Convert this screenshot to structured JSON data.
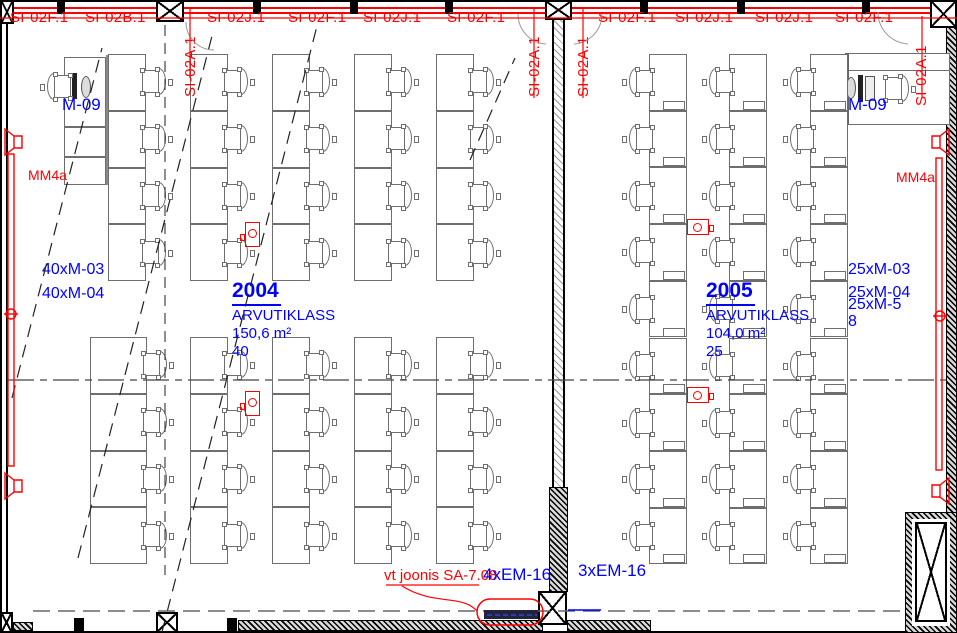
{
  "meta": {
    "drawing_type": "architectural floor plan",
    "rooms_shown": [
      "2004",
      "2005"
    ]
  },
  "colors": {
    "annotation_red": "#ff0000",
    "annotation_blue": "#0000ff",
    "furniture_line": "#6e6e6e",
    "wall": "#000000"
  },
  "top_wall_labels": [
    {
      "text": "SI-02F.1",
      "x": 10,
      "vertical": false
    },
    {
      "text": "SI-02B.1",
      "x": 85,
      "vertical": false
    },
    {
      "text": "SI-02A.1",
      "x": 182,
      "vertical": true
    },
    {
      "text": "SI-02J.1",
      "x": 207,
      "vertical": false
    },
    {
      "text": "SI-02F.1",
      "x": 288,
      "vertical": false
    },
    {
      "text": "SI-02J.1",
      "x": 363,
      "vertical": false
    },
    {
      "text": "SI-02F.1",
      "x": 447,
      "vertical": false
    },
    {
      "text": "SI-02A.1",
      "x": 526,
      "vertical": true
    },
    {
      "text": "SI-02A.1",
      "x": 575,
      "vertical": true
    },
    {
      "text": "SI-02F.1",
      "x": 598,
      "vertical": false
    },
    {
      "text": "SI-02J.1",
      "x": 675,
      "vertical": false
    },
    {
      "text": "SI-02J.1",
      "x": 755,
      "vertical": false
    },
    {
      "text": "SI-02F.1",
      "x": 835,
      "vertical": false
    },
    {
      "text": "SI-02A.1",
      "x": 913,
      "vertical": true
    }
  ],
  "rooms": [
    {
      "number": "2004",
      "name": "ARVUTIKLASS",
      "area": "150,6 m²",
      "seat_count": "40",
      "label_pos": {
        "x": 232,
        "y": 279
      },
      "equipment_labels": [
        {
          "text": "40xM-03",
          "x": 42,
          "y": 261
        },
        {
          "text": "40xM-04",
          "x": 42,
          "y": 285
        }
      ],
      "teacher_desk_label": {
        "text": "M-09"
      },
      "grid": {
        "desk_w": 38,
        "cell_h": 56.8,
        "chair_side": "right",
        "pc_notch": false,
        "groups": [
          {
            "y": 54,
            "rows": 4,
            "cols": [
              108,
              190,
              272,
              354,
              436
            ],
            "col_w": [
              38,
              38,
              38,
              38,
              38
            ]
          },
          {
            "y": 337,
            "rows": 4,
            "cols": [
              90,
              190,
              272,
              354,
              436
            ],
            "col_w": [
              57,
              38,
              38,
              38,
              38
            ]
          }
        ]
      }
    },
    {
      "number": "2005",
      "name": "ARVUTIKLASS",
      "area": "104,0 m²",
      "seat_count": "25",
      "label_pos": {
        "x": 706,
        "y": 279
      },
      "equipment_labels": [
        {
          "text": "25xM-03",
          "x": 848,
          "y": 261
        },
        {
          "text": "25xM-04",
          "x": 848,
          "y": 284
        },
        {
          "text": "25xM-5",
          "x": 848,
          "y": 296
        },
        {
          "text": "8",
          "x": 848,
          "y": 313
        }
      ],
      "teacher_desk_label": {
        "text": "M-09"
      },
      "grid": {
        "desk_w": 38,
        "cell_h": 56.7,
        "chair_side": "left",
        "pc_notch": true,
        "groups": [
          {
            "y": 54,
            "rows": 9,
            "cols": [
              649,
              729,
              810
            ],
            "col_w": [
              38,
              38,
              38
            ]
          }
        ]
      }
    }
  ],
  "wall_labels": [
    {
      "text": "MM4a",
      "x": 28,
      "y": 167
    },
    {
      "text": "MM4a",
      "x": 896,
      "y": 169
    }
  ],
  "bottom_labels": {
    "red_note": {
      "text": "vt joonis SA-7.08",
      "x": 384,
      "y": 567
    },
    "em_left": {
      "text": "4xEM-16",
      "x": 483,
      "y": 565
    },
    "em_right": {
      "text": "3xEM-16",
      "x": 578,
      "y": 561
    }
  },
  "floor_boxes": [
    {
      "x": 245,
      "y": 222,
      "orientation": "v"
    },
    {
      "x": 245,
      "y": 391,
      "orientation": "v"
    },
    {
      "x": 687,
      "y": 219,
      "orientation": "h"
    },
    {
      "x": 687,
      "y": 387,
      "orientation": "h"
    }
  ],
  "symbols": {
    "xbox": "structural-column",
    "speaker_glyph": "wall-radiator-vent-symbol",
    "floor_box": "floor-electrical-outlet",
    "chair_glyph": "task-chair-plan-symbol",
    "monitor_glyph": "computer-workstation"
  }
}
